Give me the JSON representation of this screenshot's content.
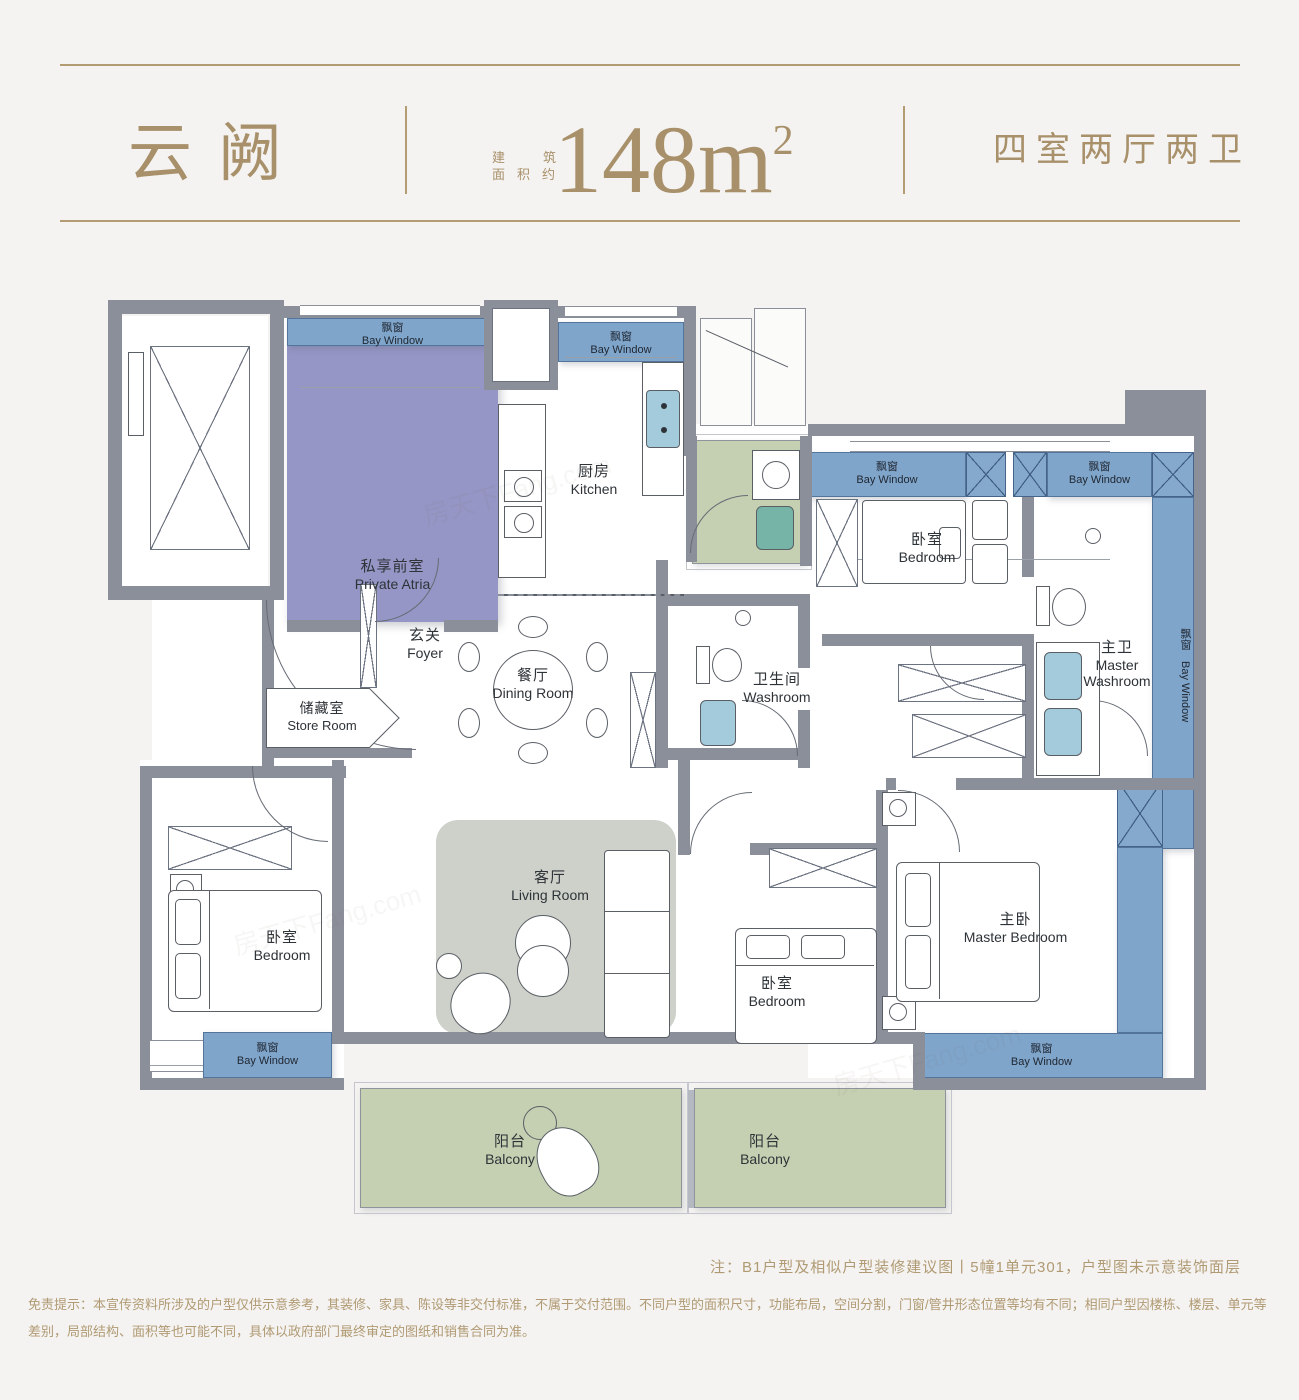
{
  "header": {
    "title": "云阙",
    "area_label_line1": "建筑",
    "area_label_line2": "面积约",
    "area_value": "148",
    "area_unit": "m",
    "area_superscript": "2",
    "layout_type": "四室两厅两卫"
  },
  "colors": {
    "gold": "#a8906a",
    "wall_gray": "#8b8f9a",
    "bay_window_blue": "#7fa5cb",
    "private_atria_purple": "#9596c5",
    "balcony_green": "#c5cfb2",
    "living_room_gray": "#cdd1ca",
    "sink_blue": "#a3cbdb"
  },
  "rooms": {
    "bay_window": {
      "zh": "飘窗",
      "en": "Bay Window"
    },
    "private_atria": {
      "zh": "私享前室",
      "en": "Private Atria"
    },
    "kitchen": {
      "zh": "厨房",
      "en": "Kitchen"
    },
    "foyer": {
      "zh": "玄关",
      "en": "Foyer"
    },
    "dining": {
      "zh": "餐厅",
      "en": "Dining Room"
    },
    "store": {
      "zh": "储藏室",
      "en": "Store Room"
    },
    "washroom": {
      "zh": "卫生间",
      "en": "Washroom"
    },
    "bedroom": {
      "zh": "卧室",
      "en": "Bedroom"
    },
    "master_washroom": {
      "zh": "主卫",
      "en": "Master Washroom"
    },
    "master_bedroom": {
      "zh": "主卧",
      "en": "Master Bedroom"
    },
    "living": {
      "zh": "客厅",
      "en": "Living Room"
    },
    "balcony": {
      "zh": "阳台",
      "en": "Balcony"
    }
  },
  "footer": {
    "note": "注：B1户型及相似户型装修建议图丨5幢1单元301，户型图未示意装饰面层",
    "disclaimer": "免责提示：本宣传资料所涉及的户型仅供示意参考，其装修、家具、陈设等非交付标准，不属于交付范围。不同户型的面积尺寸，功能布局，空间分割，门窗/管井形态位置等均有不同；相同户型因楼栋、楼层、单元等差别，局部结构、面积等也可能不同，具体以政府部门最终审定的图纸和销售合同为准。"
  },
  "watermark": "房天下Fang.com"
}
